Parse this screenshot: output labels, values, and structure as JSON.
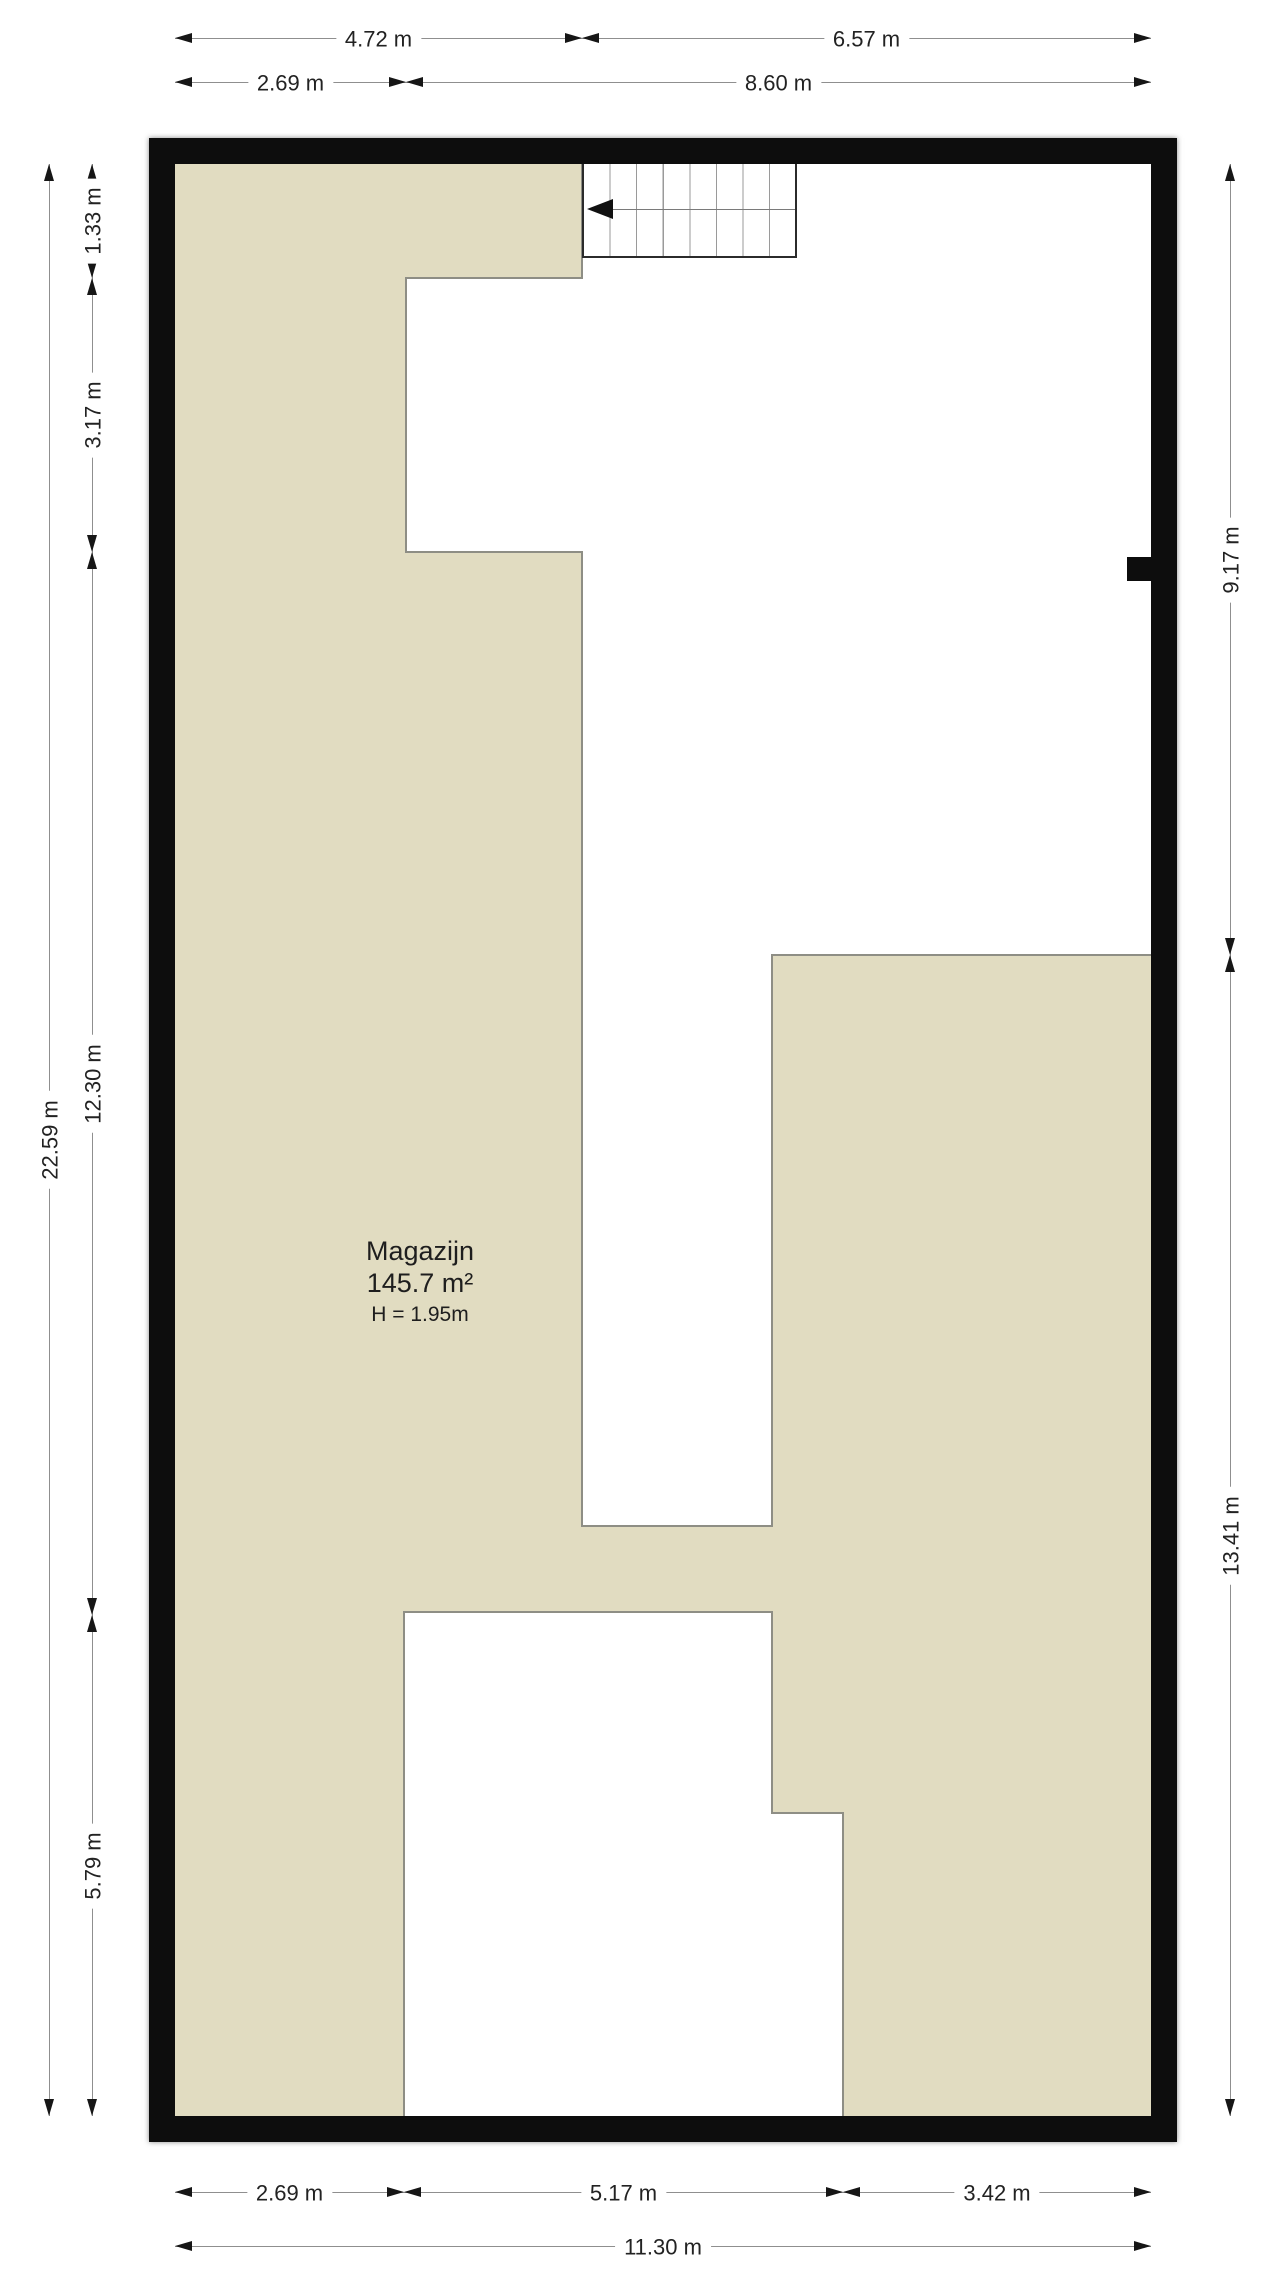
{
  "room": {
    "name": "Magazijn",
    "area": "145.7 m²",
    "height_label": "H = 1.95m"
  },
  "dimensions": {
    "top_row1": [
      "4.72 m",
      "6.57 m"
    ],
    "top_row2": [
      "2.69 m",
      "8.60 m"
    ],
    "bottom_row1": [
      "2.69 m",
      "5.17 m",
      "3.42 m"
    ],
    "bottom_row2": [
      "11.30 m"
    ],
    "left_outer": [
      "22.59 m"
    ],
    "left_inner": [
      "1.33 m",
      "3.17 m",
      "12.30 m",
      "5.79 m"
    ],
    "right": [
      "9.17 m",
      "13.41 m"
    ]
  },
  "colors": {
    "floor_fill": "#e1dcc1",
    "wall": "#0d0d0d",
    "open_area": "#ffffff",
    "open_area_border": "#8e8e85",
    "dimension_line": "#8f8f8f",
    "text": "#1e1e1e"
  },
  "icons": {
    "stairs_direction": "left-arrow"
  }
}
